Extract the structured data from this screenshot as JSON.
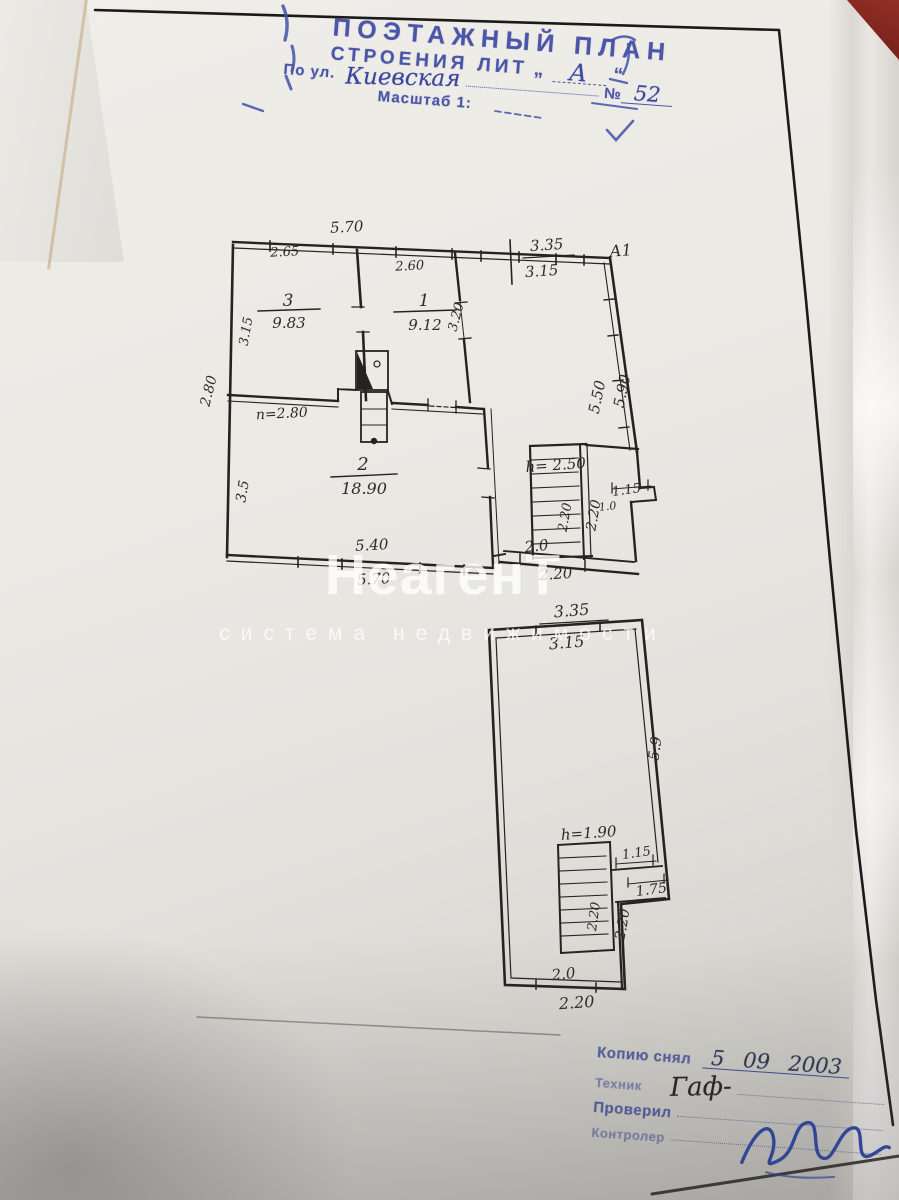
{
  "header": {
    "title": "ПОЭТАЖНЫЙ ПЛАН",
    "subtitle": "СТРОЕНИЯ ЛИТ",
    "quote_open": "„",
    "lit": "А",
    "quote_close": "“",
    "street_label": "По ул.",
    "street": "Киевская",
    "number_sign": "№",
    "number": "52",
    "scale_label": "Масштаб 1:"
  },
  "watermark": {
    "title": "НеагенТ",
    "subtitle": "система недвижимости"
  },
  "upper_plan": {
    "corner_label": "А1",
    "rooms": [
      {
        "num": "3",
        "area": "9.83"
      },
      {
        "num": "1",
        "area": "9.12"
      },
      {
        "num": "2",
        "area": "18.90"
      }
    ],
    "dims": {
      "top_out": "5.70",
      "seg_left": "2.65",
      "seg_mid": "2.60",
      "right_top_out": "3.35",
      "right_top_in": "3.15",
      "left_in": "3.15",
      "left_out": "2.80",
      "room1_right": "3.20",
      "height_note": "п=2.80",
      "left_low": "3.5",
      "diag_in": "5.50",
      "diag_out": "5.90",
      "stairs_height": "h= 2.50",
      "stairs_run": "2.20",
      "hall_side": "2.20",
      "step_top": "1.15",
      "step_bottom": "1.0",
      "porch_in": "2.0",
      "porch_out": "2.20",
      "bottom_in": "5.40",
      "bottom_out": "5.70"
    }
  },
  "lower_plan": {
    "dims": {
      "top_out": "3.35",
      "top_in": "3.15",
      "right_side": "5.9",
      "stairs_height": "h=1.90",
      "step_top": "1.15",
      "step_bottom": "1.75",
      "stairs_run": "2.20",
      "side_out": "2.20",
      "bottom_in": "2.0",
      "bottom_out": "2.20"
    }
  },
  "footer": {
    "copy_label": "Копию снял",
    "copy_date": "5 09 2003",
    "technician_label": "Техник",
    "technician_sig": "Гаф-",
    "checked_label": "Проверил",
    "controller_label": "Контролер"
  }
}
